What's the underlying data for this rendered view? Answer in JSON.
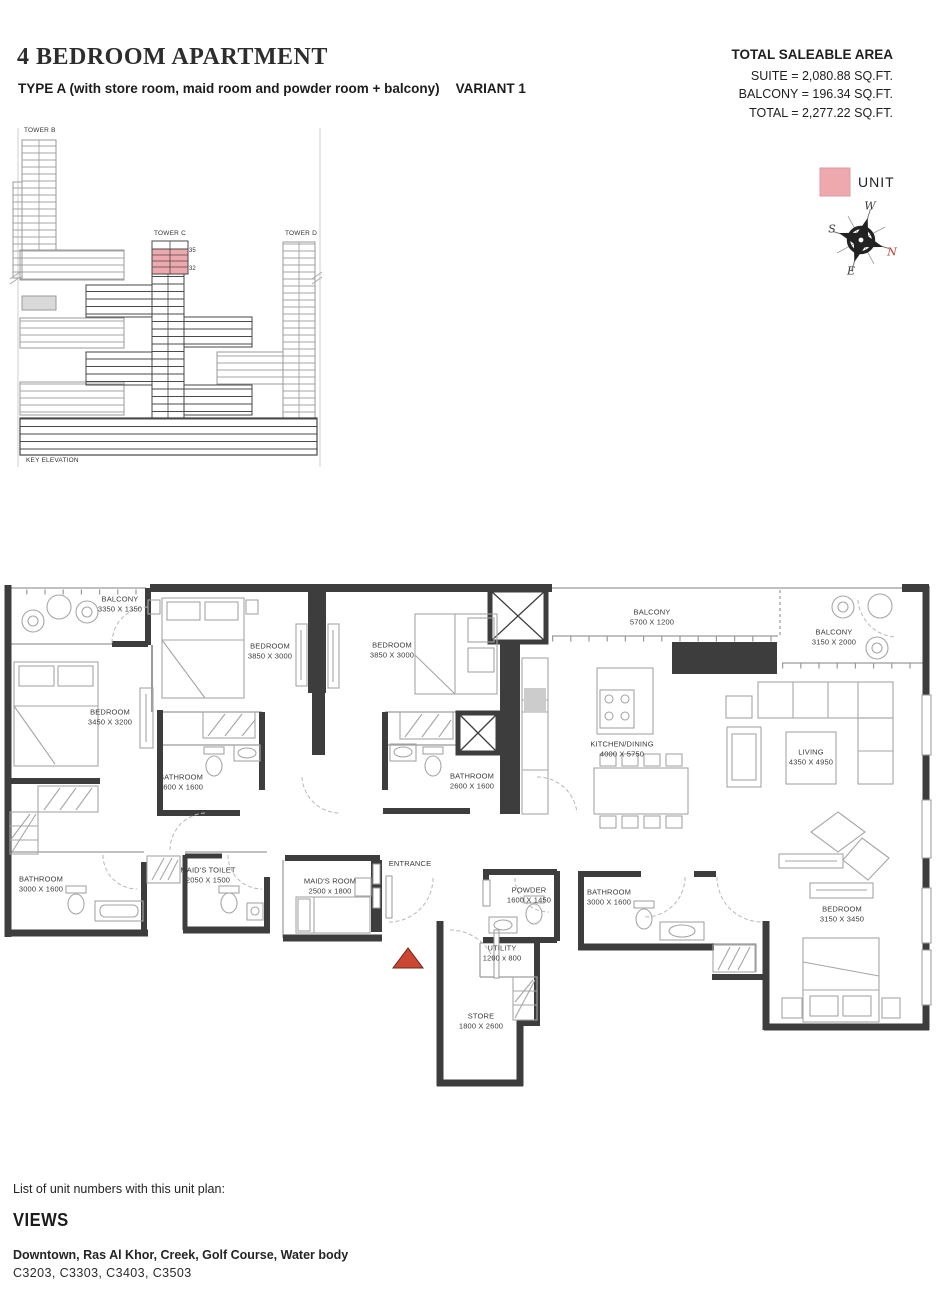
{
  "header": {
    "title": "4 BEDROOM APARTMENT",
    "subtitle": "TYPE A (with store room, maid room and powder room + balcony)",
    "variant": "VARIANT 1",
    "area": {
      "heading": "TOTAL SALEABLE AREA",
      "suite": "SUITE = 2,080.88 SQ.FT.",
      "balcony": "BALCONY = 196.34 SQ.FT.",
      "total": "TOTAL = 2,277.22 SQ.FT."
    }
  },
  "elevation": {
    "tower_b": "TOWER B",
    "tower_c": "TOWER C",
    "tower_d": "TOWER D",
    "floor_top": "35",
    "floor_bottom": "32",
    "caption": "KEY ELEVATION"
  },
  "legend": {
    "unit_label": "UNIT",
    "swatch_color": "#eda9ae"
  },
  "compass": {
    "w": "W",
    "s": "S",
    "e": "E",
    "n": "N"
  },
  "plan": {
    "entrance_label": "ENTRANCE",
    "rooms": [
      {
        "name": "BALCONY",
        "dims": "3350 X 1350"
      },
      {
        "name": "BEDROOM",
        "dims": "3850 X 3000"
      },
      {
        "name": "BEDROOM",
        "dims": "3850 X 3000"
      },
      {
        "name": "BALCONY",
        "dims": "5700 X 1200"
      },
      {
        "name": "BALCONY",
        "dims": "3150 X 2000"
      },
      {
        "name": "BEDROOM",
        "dims": "3450 X 3200"
      },
      {
        "name": "BATHROOM",
        "dims": "2600 X 1600"
      },
      {
        "name": "BATHROOM",
        "dims": "2600 X 1600"
      },
      {
        "name": "KITCHEN/DINING",
        "dims": "4000 X 5750"
      },
      {
        "name": "LIVING",
        "dims": "4350 X 4950"
      },
      {
        "name": "BATHROOM",
        "dims": "3000 X 1600"
      },
      {
        "name": "MAID'S TOILET",
        "dims": "2050 X 1500"
      },
      {
        "name": "MAID'S ROOM",
        "dims": "2500 x 1800"
      },
      {
        "name": "POWDER",
        "dims": "1600 X 1450"
      },
      {
        "name": "UTILITY",
        "dims": "1200 x 800"
      },
      {
        "name": "STORE",
        "dims": "1800 X 2600"
      },
      {
        "name": "BATHROOM",
        "dims": "3000 X 1600"
      },
      {
        "name": "BEDROOM",
        "dims": "3150 X 3450"
      }
    ]
  },
  "footer": {
    "list_heading": "List of unit numbers with this unit plan:",
    "views_heading": "VIEWS",
    "views_list": "Downtown, Ras Al Khor, Creek, Golf Course, Water body",
    "unit_numbers": "C3203, C3303, C3403, C3503"
  },
  "colors": {
    "unit_pink": "#eda9ae",
    "wall": "#3d3d3d",
    "entrance_marker": "#cc4733",
    "north_red": "#c0392b"
  }
}
